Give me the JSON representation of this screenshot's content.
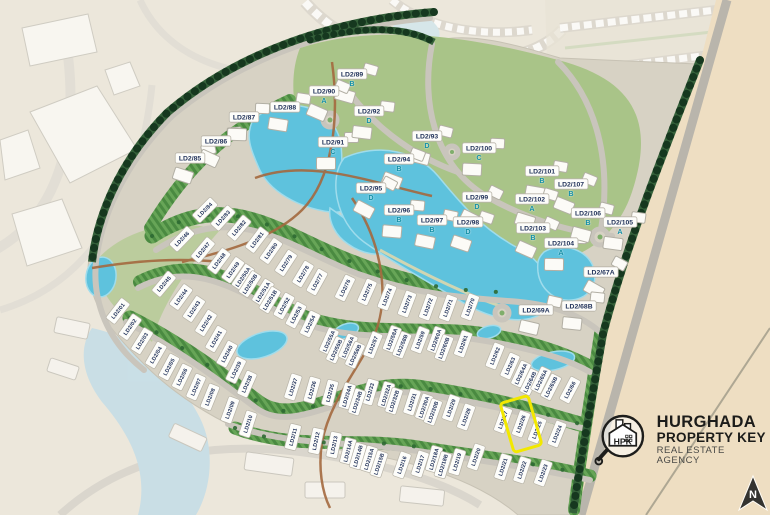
{
  "map": {
    "project_prefix": "LD2",
    "colors": {
      "highlight_yellow": "#F2E800",
      "water_blue": "#5EC2DD",
      "fairway_green": "#4A8A41",
      "landscape_green": "#A9C488",
      "sand_beige": "#EEDEC2",
      "road_gray": "#C9C5BC",
      "plot_text_navy": "#21325A",
      "cluster_letter_teal": "#128FA6",
      "logo_black": "#1D1D1B"
    },
    "highlight": {
      "plot_id": "LD2/26",
      "cx": 521,
      "cy": 424,
      "width": 26,
      "height": 48,
      "rotation": -16,
      "color": "#F2E800"
    },
    "villa_plots": [
      [
        "LD2/01",
        118,
        311,
        -52
      ],
      [
        "LD2/02",
        130,
        327,
        -55
      ],
      [
        "LD2/03",
        142,
        341,
        -58
      ],
      [
        "LD2/04",
        156,
        355,
        -60
      ],
      [
        "LD2/05",
        169,
        367,
        -62
      ],
      [
        "LD2/06",
        182,
        377,
        -64
      ],
      [
        "LD2/07",
        196,
        387,
        -66
      ],
      [
        "LD2/08",
        210,
        397,
        -68
      ],
      [
        "LD2/09",
        230,
        410,
        -70
      ],
      [
        "LD2/10",
        248,
        424,
        -72
      ],
      [
        "LD2/11",
        293,
        437,
        -76
      ],
      [
        "LD2/12",
        316,
        441,
        -78
      ],
      [
        "LD2/13",
        334,
        445,
        -78
      ],
      [
        "LD2/14A",
        348,
        451,
        -76
      ],
      [
        "LD2/14B",
        358,
        456,
        -74
      ],
      [
        "LD2/15A",
        369,
        459,
        -73
      ],
      [
        "LD2/15B",
        379,
        464,
        -72
      ],
      [
        "LD2/16",
        402,
        465,
        -71
      ],
      [
        "LD2/17",
        420,
        464,
        -72
      ],
      [
        "LD2/18A",
        434,
        459,
        -74
      ],
      [
        "LD2/18B",
        443,
        465,
        -73
      ],
      [
        "LD2/19",
        457,
        462,
        -73
      ],
      [
        "LD2/20",
        476,
        457,
        -71
      ],
      [
        "LD2/21",
        503,
        467,
        -72
      ],
      [
        "LD2/22",
        522,
        470,
        -72
      ],
      [
        "LD2/23",
        543,
        473,
        -70
      ],
      [
        "LD2/24",
        557,
        434,
        -68
      ],
      [
        "LD2/25",
        537,
        430,
        -69
      ],
      [
        "LD2/26",
        521,
        424,
        -70
      ],
      [
        "LD2/27",
        503,
        420,
        -70
      ],
      [
        "LD2/28",
        466,
        417,
        -70
      ],
      [
        "LD2/29",
        451,
        408,
        -71
      ],
      [
        "LD2/30A",
        424,
        407,
        -71
      ],
      [
        "LD2/30B",
        433,
        412,
        -70
      ],
      [
        "LD2/31",
        412,
        402,
        -72
      ],
      [
        "LD2/32A",
        386,
        395,
        -73
      ],
      [
        "LD2/32B",
        394,
        401,
        -72
      ],
      [
        "LD2/33",
        370,
        392,
        -74
      ],
      [
        "LD2/34A",
        347,
        396,
        -74
      ],
      [
        "LD2/34B",
        357,
        402,
        -72
      ],
      [
        "LD2/35",
        330,
        393,
        -75
      ],
      [
        "LD2/36",
        312,
        390,
        -74
      ],
      [
        "LD2/37",
        293,
        387,
        -72
      ],
      [
        "LD2/38",
        247,
        384,
        -66
      ],
      [
        "LD2/39",
        236,
        370,
        -64
      ],
      [
        "LD2/40",
        227,
        354,
        -62
      ],
      [
        "LD2/41",
        216,
        339,
        -60
      ],
      [
        "LD2/42",
        206,
        323,
        -58
      ],
      [
        "LD2/43",
        194,
        309,
        -56
      ],
      [
        "LD2/44",
        181,
        297,
        -54
      ],
      [
        "LD2/45",
        164,
        284,
        -50
      ],
      [
        "LD2/46",
        182,
        239,
        -46
      ],
      [
        "LD2/47",
        203,
        250,
        -50
      ],
      [
        "LD2/48",
        219,
        261,
        -53
      ],
      [
        "LD2/49",
        233,
        270,
        -55
      ],
      [
        "LD2/50A",
        243,
        277,
        -56
      ],
      [
        "LD2/50B",
        250,
        284,
        -57
      ],
      [
        "LD2/51A",
        263,
        292,
        -58
      ],
      [
        "LD2/51B",
        270,
        300,
        -59
      ],
      [
        "LD2/52",
        284,
        306,
        -61
      ],
      [
        "LD2/53",
        296,
        315,
        -62
      ],
      [
        "LD2/54",
        310,
        324,
        -64
      ],
      [
        "LD2/55A",
        329,
        341,
        -66
      ],
      [
        "LD2/55B",
        336,
        350,
        -65
      ],
      [
        "LD2/56A",
        348,
        347,
        -66
      ],
      [
        "LD2/56B",
        355,
        355,
        -65
      ],
      [
        "LD2/57",
        373,
        345,
        -68
      ],
      [
        "LD2/58A",
        392,
        339,
        -69
      ],
      [
        "LD2/58B",
        402,
        345,
        -68
      ],
      [
        "LD2/59",
        420,
        340,
        -69
      ],
      [
        "LD2/60A",
        436,
        340,
        -70
      ],
      [
        "LD2/60B",
        444,
        348,
        -69
      ],
      [
        "LD2/61",
        463,
        344,
        -70
      ],
      [
        "LD2/62",
        495,
        356,
        -68
      ],
      [
        "LD2/63",
        510,
        366,
        -66
      ],
      [
        "LD2/64A",
        521,
        374,
        -65
      ],
      [
        "LD2/64B",
        530,
        382,
        -64
      ],
      [
        "LD2/65A",
        541,
        380,
        -64
      ],
      [
        "LD2/65B",
        551,
        387,
        -63
      ],
      [
        "LD2/66",
        570,
        390,
        -62
      ],
      [
        "LD2/70",
        470,
        307,
        -70
      ],
      [
        "LD2/71",
        448,
        308,
        -70
      ],
      [
        "LD2/72",
        428,
        307,
        -70
      ],
      [
        "LD2/73",
        407,
        304,
        -69
      ],
      [
        "LD2/74",
        387,
        297,
        -68
      ],
      [
        "LD2/75",
        367,
        292,
        -66
      ],
      [
        "LD2/76",
        345,
        288,
        -64
      ],
      [
        "LD2/77",
        317,
        282,
        -61
      ],
      [
        "LD2/78",
        303,
        274,
        -59
      ],
      [
        "LD2/79",
        286,
        263,
        -57
      ],
      [
        "LD2/80",
        271,
        251,
        -55
      ],
      [
        "LD2/81",
        257,
        240,
        -53
      ],
      [
        "LD2/82",
        239,
        228,
        -50
      ],
      [
        "LD2/83",
        223,
        218,
        -48
      ],
      [
        "LD2/84",
        205,
        210,
        -45
      ]
    ],
    "cluster_plots": [
      [
        "LD2/85",
        190,
        158,
        ""
      ],
      [
        "LD2/86",
        216,
        141,
        ""
      ],
      [
        "LD2/87",
        244,
        117,
        ""
      ],
      [
        "LD2/88",
        285,
        107,
        ""
      ],
      [
        "LD2/89",
        352,
        78,
        "B"
      ],
      [
        "LD2/90",
        324,
        95,
        "A"
      ],
      [
        "LD2/91",
        333,
        146,
        "C"
      ],
      [
        "LD2/92",
        369,
        115,
        "D"
      ],
      [
        "LD2/93",
        427,
        140,
        "D"
      ],
      [
        "LD2/94",
        399,
        163,
        "B"
      ],
      [
        "LD2/95",
        371,
        192,
        "D"
      ],
      [
        "LD2/96",
        399,
        214,
        "B"
      ],
      [
        "LD2/97",
        432,
        224,
        "B"
      ],
      [
        "LD2/98",
        468,
        226,
        "D"
      ],
      [
        "LD2/99",
        477,
        201,
        "D"
      ],
      [
        "LD2/100",
        479,
        152,
        "C"
      ],
      [
        "LD2/101",
        542,
        175,
        "B"
      ],
      [
        "LD2/102",
        532,
        203,
        "A"
      ],
      [
        "LD2/103",
        533,
        232,
        "B"
      ],
      [
        "LD2/104",
        561,
        247,
        "A"
      ],
      [
        "LD2/105",
        620,
        226,
        "A"
      ],
      [
        "LD2/106",
        588,
        217,
        "B"
      ],
      [
        "LD2/107",
        571,
        188,
        "B"
      ],
      [
        "LD2/67A",
        601,
        272,
        ""
      ],
      [
        "LD2/68B",
        579,
        306,
        ""
      ],
      [
        "LD2/69A",
        536,
        310,
        ""
      ]
    ]
  },
  "branding": {
    "monogram": "HPK",
    "line1": "HURGHADA",
    "line2": "PROPERTY KEY",
    "line3": "REAL ESTATE AGENCY"
  },
  "compass": {
    "label": "N"
  }
}
